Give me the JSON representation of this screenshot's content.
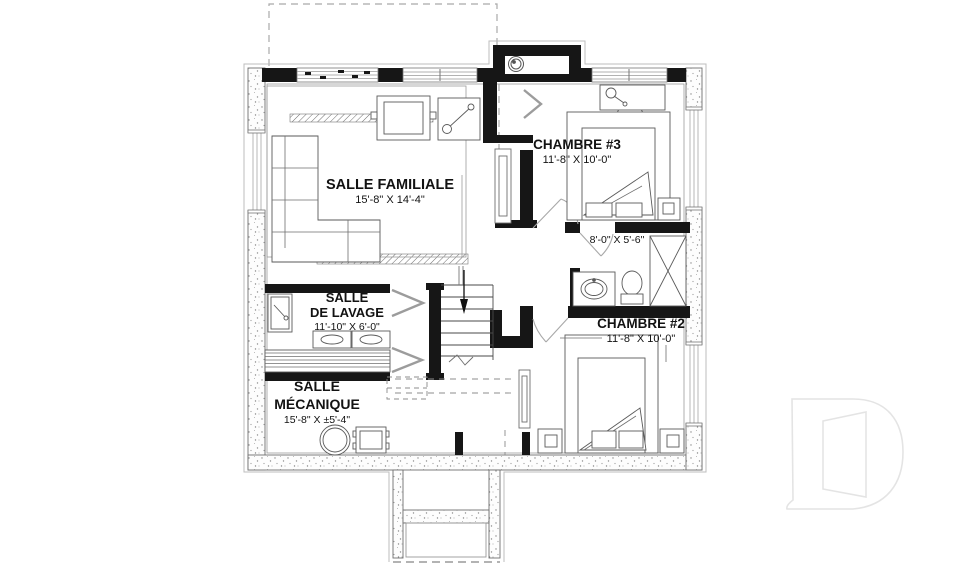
{
  "rooms": {
    "salle_familiale": {
      "name": "SALLE FAMILIALE",
      "dims": "15'-8\" X 14'-4\""
    },
    "chambre_3": {
      "name": "CHAMBRE #3",
      "dims": "11'-8\" X 10'-0\""
    },
    "salle_de_bain": {
      "dims": "8'-0\" X 5'-6\""
    },
    "chambre_2": {
      "name": "CHAMBRE #2",
      "dims": "11'-8\" X 10'-0\""
    },
    "salle_de_lavage": {
      "name_line1": "SALLE",
      "name_line2": "DE LAVAGE",
      "dims": "11'-10\" X 6'-0\""
    },
    "salle_mecanique": {
      "name_line1": "SALLE",
      "name_line2": "MÉCANIQUE",
      "dims": "15'-8\" X ±5'-4\""
    }
  },
  "colors": {
    "wall_black": "#161616",
    "line_gray": "#8c8c8c",
    "watermark_gray": "#e4e4e4",
    "background": "#ffffff"
  }
}
